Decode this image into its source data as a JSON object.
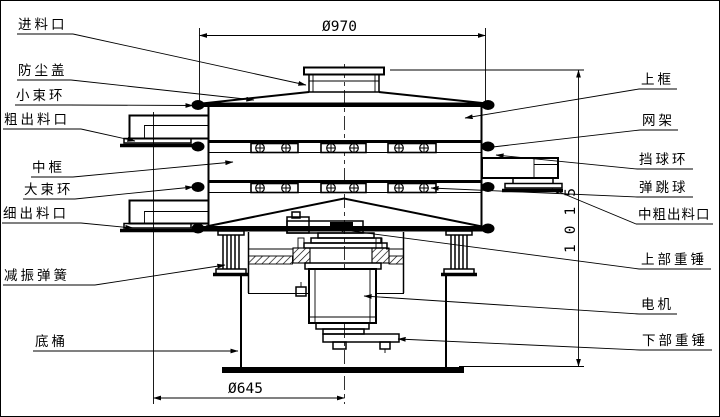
{
  "drawing": {
    "labels_left": [
      {
        "id": "feed-inlet",
        "text": "进料口"
      },
      {
        "id": "dust-cover",
        "text": "防尘盖"
      },
      {
        "id": "small-clamp-ring",
        "text": "小束环"
      },
      {
        "id": "coarse-outlet",
        "text": "粗出料口"
      },
      {
        "id": "middle-frame",
        "text": "中框"
      },
      {
        "id": "large-clamp-ring",
        "text": "大束环"
      },
      {
        "id": "fine-outlet",
        "text": "细出料口"
      },
      {
        "id": "damping-spring",
        "text": "减振弹簧"
      },
      {
        "id": "base-drum",
        "text": "底桶"
      }
    ],
    "labels_right": [
      {
        "id": "upper-frame",
        "text": "上框"
      },
      {
        "id": "screen-frame",
        "text": "网架"
      },
      {
        "id": "ball-stop-ring",
        "text": "挡球环"
      },
      {
        "id": "bouncing-ball",
        "text": "弹跳球"
      },
      {
        "id": "medium-coarse-outlet",
        "text": "中粗出料口"
      },
      {
        "id": "upper-weight",
        "text": "上部重锤"
      },
      {
        "id": "motor",
        "text": "电机"
      },
      {
        "id": "lower-weight",
        "text": "下部重锤"
      }
    ],
    "dimensions": {
      "top_diameter": "Ø970",
      "overall_height": "1015",
      "bottom_diameter": "Ø645"
    },
    "colors": {
      "line": "#000000",
      "background": "#ffffff"
    }
  }
}
